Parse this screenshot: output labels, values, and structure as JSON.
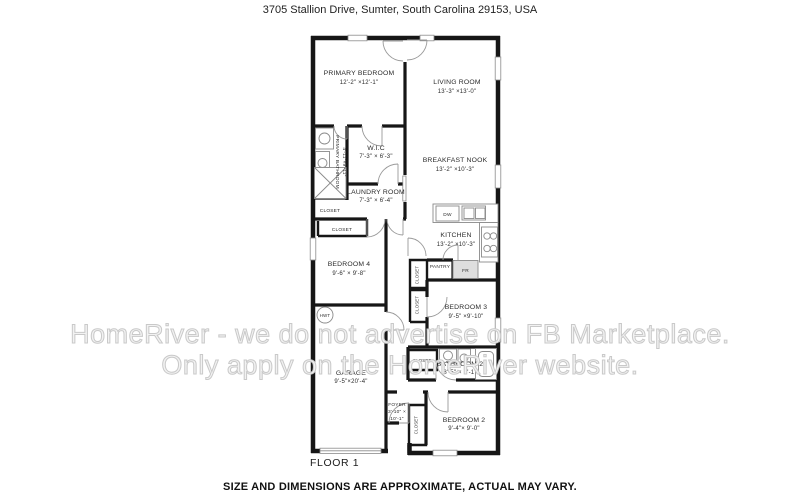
{
  "title": "3705 Stallion Drive, Sumter, South Carolina 29153, USA",
  "watermark": {
    "line1": "HomeRiver - we do not advertise on FB Marketplace.",
    "line2": "Only apply on the HomeRiver website."
  },
  "floor": {
    "label": "FLOOR 1"
  },
  "disclaimer": "SIZE AND DIMENSIONS ARE APPROXIMATE, ACTUAL MAY VARY.",
  "rooms": {
    "primary_bedroom": {
      "name": "PRIMARY BEDROOM",
      "dims": "12'-2\" ×12'-1\""
    },
    "living_room": {
      "name": "LIVING ROOM",
      "dims": "13'-3\" ×13'-0\""
    },
    "primary_bathroom": {
      "name": "PRIMARY BATHROOM",
      "dims": "4'-11\"×9'-11\""
    },
    "wic": {
      "name": "W.I.C",
      "dims": "7'-3\" × 6'-3\""
    },
    "breakfast_nook": {
      "name": "BREAKFAST NOOK",
      "dims": "13'-2\" ×10'-3\""
    },
    "laundry_room": {
      "name": "LAUNDRY ROOM",
      "dims": "7'-3\" × 6'-4\""
    },
    "kitchen": {
      "name": "KITCHEN",
      "dims": "13'-2\" ×10'-3\""
    },
    "bedroom4": {
      "name": "BEDROOM 4",
      "dims": "9'-6\" × 9'-8\""
    },
    "bedroom3": {
      "name": "BEDROOM 3",
      "dims": "9'-5\" ×9'-10\""
    },
    "bedroom2": {
      "name": "BEDROOM 2",
      "dims": "9'-4\"× 9'-0\""
    },
    "bathroom2": {
      "name": "BATHROOM 2",
      "dims": "8'-5\" × 5'-1\""
    },
    "garage": {
      "name": "GARAGE",
      "dims": "9'-5\"×20'-4\""
    },
    "foyer": {
      "name": "FOYER",
      "dims1": "3'-10\" ×",
      "dims2": "10'-1\""
    }
  },
  "labels": {
    "closet": "CLOSET",
    "pantry": "PANTRY",
    "dw": "DW",
    "fr": "FR",
    "hwt": "HWT"
  }
}
